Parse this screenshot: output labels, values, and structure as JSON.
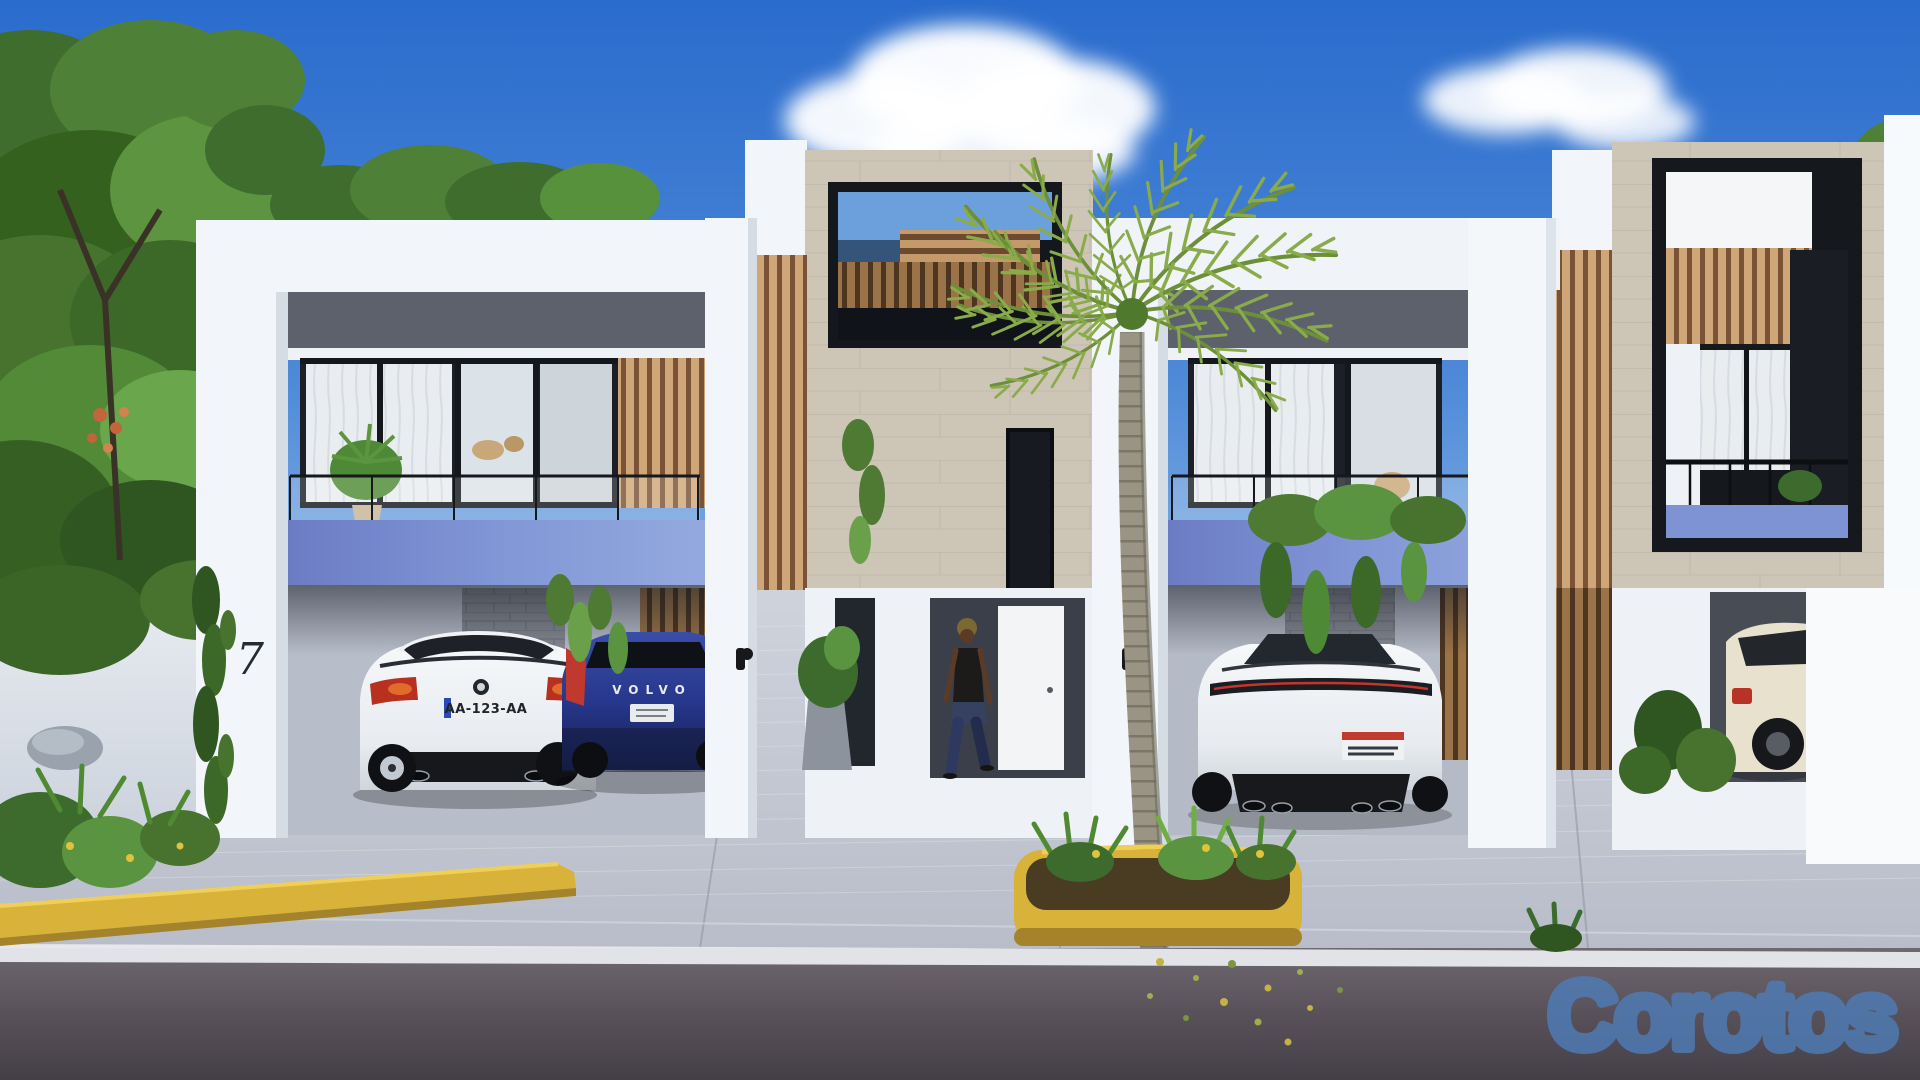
{
  "watermark": {
    "text": "Corotos",
    "color": "#4e7db8"
  },
  "buildings": {
    "unit1": {
      "house_number": "7"
    }
  },
  "vehicles": {
    "bmw_coupe": {
      "plate": "AA-123-AA",
      "color": "#f2f4f6"
    },
    "volvo_hatchback": {
      "tailgate_lettering": "VOLVO",
      "color": "#2c3f92"
    },
    "sports_sedan": {
      "color": "#eef0f3"
    },
    "suv_partial": {
      "color": "#e8e1cd"
    }
  },
  "palette": {
    "sky_top": "#2a6ccd",
    "sky_horizon": "#d9e8f4",
    "balcony_accent_blue": "#7e93d4",
    "concrete_band_gray": "#5c616b",
    "travertine_stone": "#cdc5b6",
    "wood_slat": "#c8a073",
    "foliage_green": "#4e7a34",
    "curb_yellow": "#d9b23a",
    "driveway_gray": "#c3c8d3",
    "road_asphalt": "#55505a"
  }
}
